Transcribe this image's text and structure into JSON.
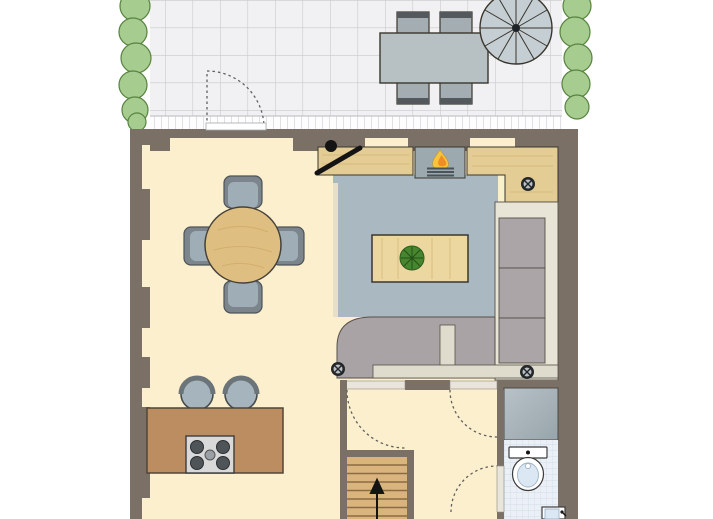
{
  "meta": {
    "title": "Ground-floor architectural plan with terrace",
    "diagram_type": "floor-plan",
    "canvas": {
      "width": 713,
      "height": 519
    },
    "visible_text": []
  },
  "areas": {
    "terrace": {
      "features": [
        "tiled-paving",
        "hedge-left",
        "hedge-right",
        "edge-border",
        "terrace-door-swing"
      ],
      "furniture": [
        "outdoor-dining-table",
        "outdoor-chair x4",
        "parasol"
      ]
    },
    "living_dining": {
      "furniture": [
        "round-dining-table",
        "dining-chair x4",
        "cooking-island-with-hob",
        "bar-stool x2"
      ]
    },
    "kitchen": {
      "furniture": [
        "worktop-left",
        "built-in-appliance-with-flame",
        "worktop-right-L",
        "tall-cabinet-column",
        "rounded-counter-bar",
        "table-with-plant"
      ],
      "symbols": [
        "drain-screw x3",
        "open-door-leaf"
      ]
    },
    "hallway": {
      "features": [
        "staircase-up-arrow",
        "door-swing x3",
        "door-panel x3"
      ]
    },
    "bathroom": {
      "fixtures": [
        "shower",
        "toilet",
        "washbasin"
      ]
    },
    "wall_openings": {
      "top_wall_windows": 3,
      "left_wall_windows": 5
    }
  },
  "icons": [
    {
      "name": "flame-icon",
      "meaning": "stove/fireplace"
    },
    {
      "name": "plant-icon",
      "meaning": "potted plant top view"
    },
    {
      "name": "up-arrow-icon",
      "meaning": "stair direction up"
    },
    {
      "name": "drain-screw-icon",
      "meaning": "outlet/drain symbol"
    },
    {
      "name": "parasol-icon",
      "meaning": "umbrella top view"
    }
  ],
  "palette": {
    "wall": "#7a7066",
    "floor": "#fcefcd",
    "patio_tile": "#f1f1f3",
    "patio_grid": "#c9c9ce",
    "edge_tick": "#c4c4ca",
    "hedge": "#a7cc90",
    "hedge_edge": "#57833f",
    "hedge_line": "#3f6b33",
    "outdoor_table": "#b7c1c4",
    "outdoor_chair": "#a4aeb2",
    "outdoor_chair_back": "#53595c",
    "parasol": "#c5ced2",
    "dark_outline": "#3a362e",
    "dining_table_wood": "#dfbf81",
    "chair_dark": "#7c858c",
    "chair_light": "#9fadb6",
    "kitchen_floor": "#aab9c1",
    "worktop_wood": "#e4cd95",
    "appliance_gray": "#9ca9af",
    "flame_yellow": "#f7c53d",
    "flame_orange": "#ee8d28",
    "cabinet_band": "#e8e4d6",
    "cabinet_panel": "#aba5a7",
    "counter_gray": "#a9a3a5",
    "counter_strip": "#dfdbcd",
    "island_brown": "#bb8d61",
    "cooktop": "#d9d9d9",
    "burner": "#4e5457",
    "stool": "#a6b4bd",
    "stool_back": "#6b7478",
    "stair_wood": "#d9b47c",
    "stair_line": "#8a6b43",
    "bath_tile": "#eaf0f6",
    "bath_grid": "#ccd9e7",
    "shower_light": "#b8c2c7",
    "shower_dark": "#97a5ab",
    "fixture_white": "#ffffff",
    "fixture_blue": "#dbe7f2",
    "dash": "#5f5f5f",
    "black": "#141414",
    "door_panel": "#e9e5da",
    "coffee_table": "#ecd7a0",
    "plant": "#47852f",
    "seam": "#55504a"
  }
}
